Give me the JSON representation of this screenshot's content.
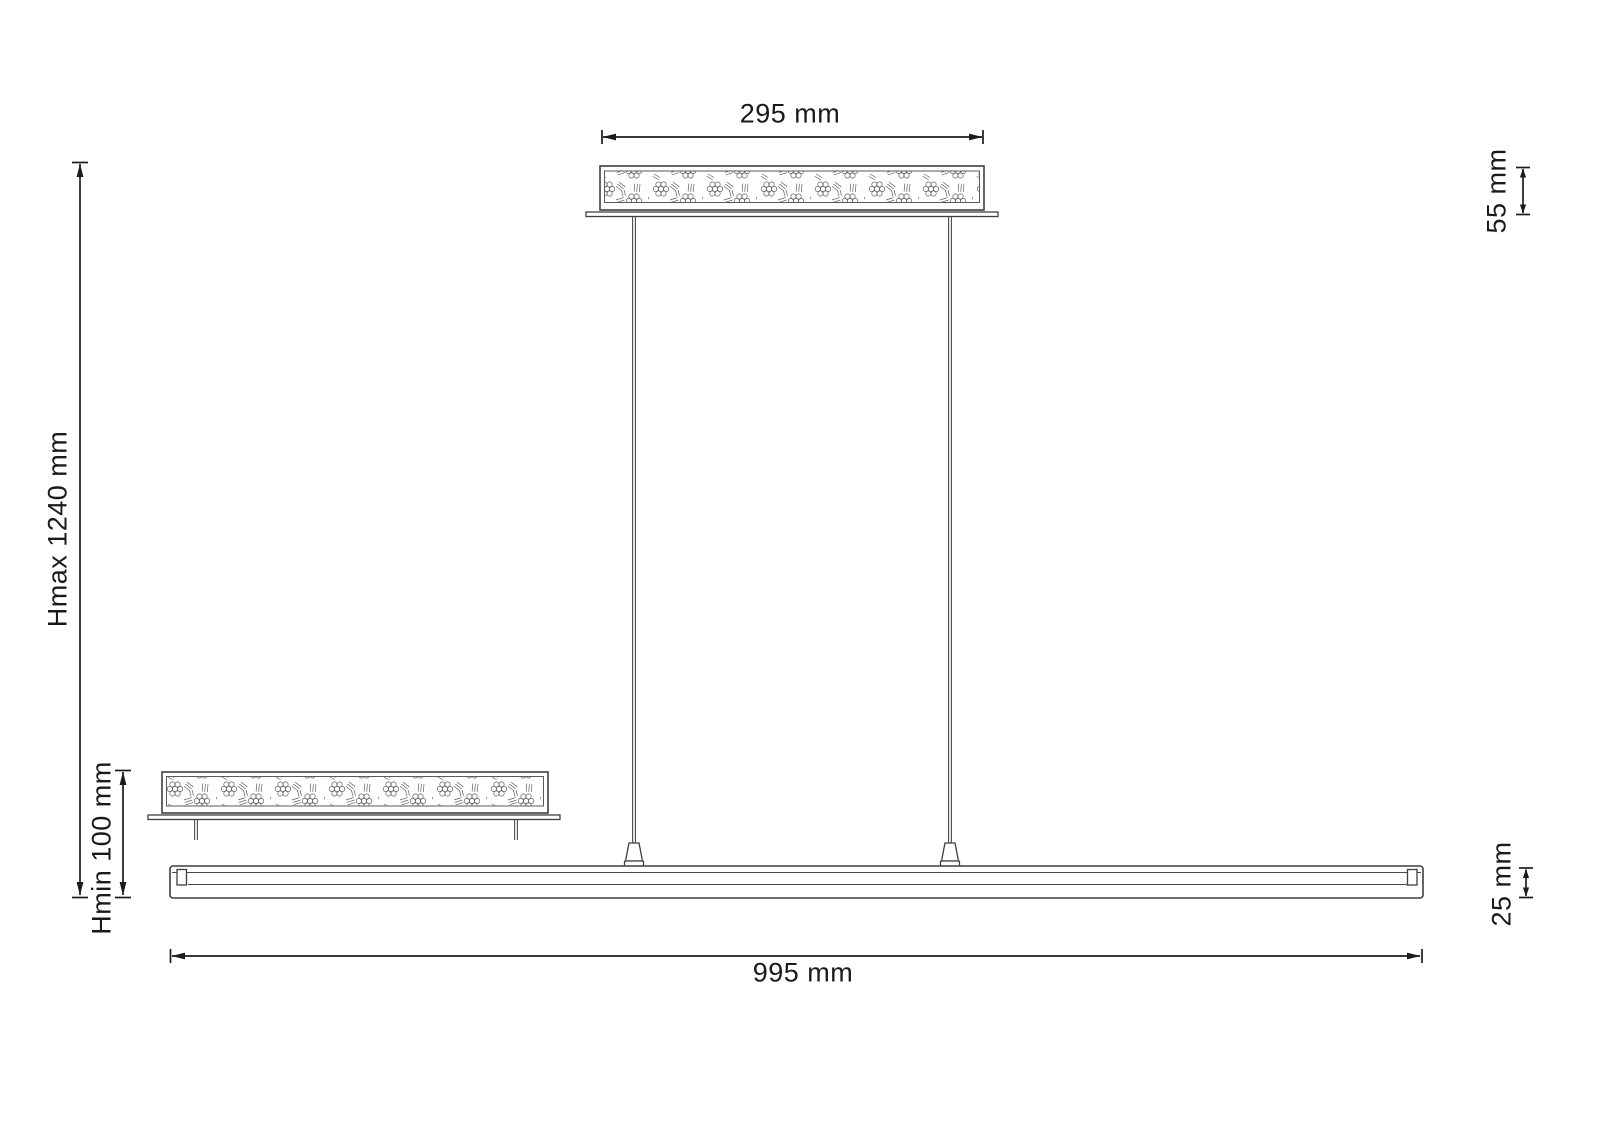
{
  "diagram": {
    "background_color": "#ffffff",
    "line_color": "#3f3f3f",
    "dimension_color": "#1c1c1c",
    "texture_color": "#5f5f5f",
    "dimensions": {
      "canopy_width": "295 mm",
      "canopy_height": "55 mm",
      "max_height": "Hmax 1240 mm",
      "min_height": "Hmin 100 mm",
      "bar_length": "995 mm",
      "bar_height": "25 mm"
    }
  }
}
